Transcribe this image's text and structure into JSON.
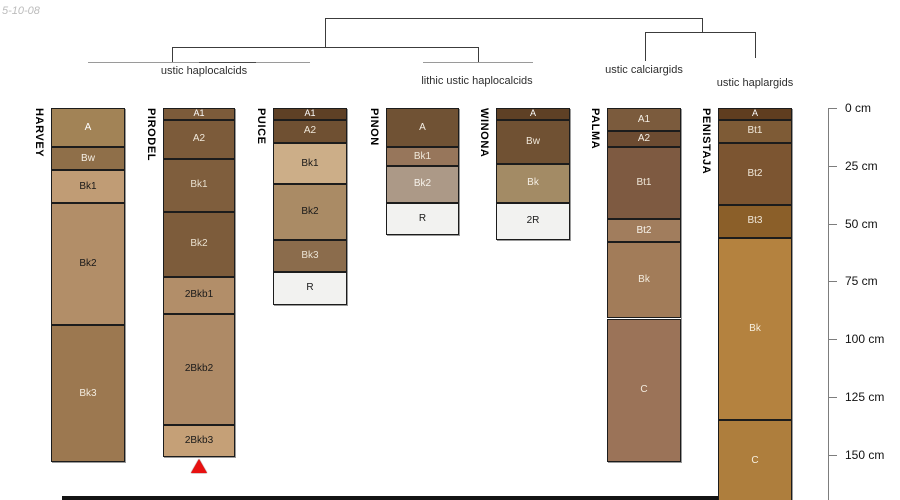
{
  "date_label": "5-10-08",
  "dendrogram": {
    "groups": [
      {
        "label": "ustic haplocalcids",
        "members": [
          "HARVEY",
          "PIRODEL",
          "PUICE"
        ]
      },
      {
        "label": "lithic ustic haplocalcids",
        "members": [
          "PINON",
          "WINONA"
        ]
      },
      {
        "label": "ustic calciargids",
        "members": [
          "PALMA"
        ]
      },
      {
        "label": "ustic haplargids",
        "members": [
          "PENISTAJA"
        ]
      }
    ]
  },
  "depth_scale": {
    "unit": "cm",
    "ticks": [
      {
        "value": 0,
        "label": "0 cm"
      },
      {
        "value": 25,
        "label": "25 cm"
      },
      {
        "value": 50,
        "label": "50 cm"
      },
      {
        "value": 75,
        "label": "75 cm"
      },
      {
        "value": 100,
        "label": "100 cm"
      },
      {
        "value": 125,
        "label": "125 cm"
      },
      {
        "value": 150,
        "label": "150 cm"
      }
    ]
  },
  "profiles": [
    {
      "name": "HARVEY",
      "x": 51,
      "width": 74,
      "horizons": [
        {
          "label": "A",
          "top_cm": 0,
          "bottom_cm": 17,
          "color": "#a28356",
          "text_color": "#ffffff"
        },
        {
          "label": "Bw",
          "top_cm": 17,
          "bottom_cm": 27,
          "color": "#8f6f49",
          "text_color": "#f5efe5"
        },
        {
          "label": "Bk1",
          "top_cm": 27,
          "bottom_cm": 41,
          "color": "#c09c75",
          "text_color": "#1a1a1a"
        },
        {
          "label": "Bk2",
          "top_cm": 41,
          "bottom_cm": 94,
          "color": "#b28e68",
          "text_color": "#1a1a1a"
        },
        {
          "label": "Bk3",
          "top_cm": 94,
          "bottom_cm": 153,
          "color": "#9c7850",
          "text_color": "#f3ecdf"
        }
      ]
    },
    {
      "name": "PIRODEL",
      "x": 163,
      "width": 72,
      "marker": "red-triangle",
      "horizons": [
        {
          "label": "A1",
          "top_cm": 0,
          "bottom_cm": 5,
          "color": "#7c5b3a",
          "text_color": "#ffffff"
        },
        {
          "label": "A2",
          "top_cm": 5,
          "bottom_cm": 22,
          "color": "#7c5b3a",
          "text_color": "#f0e8da"
        },
        {
          "label": "Bk1",
          "top_cm": 22,
          "bottom_cm": 45,
          "color": "#7f5e3d",
          "text_color": "#e9e0cf"
        },
        {
          "label": "Bk2",
          "top_cm": 45,
          "bottom_cm": 73,
          "color": "#7d5c3b",
          "text_color": "#e9e0cf"
        },
        {
          "label": "2Bkb1",
          "top_cm": 73,
          "bottom_cm": 89,
          "color": "#b28e69",
          "text_color": "#1a1a1a"
        },
        {
          "label": "2Bkb2",
          "top_cm": 89,
          "bottom_cm": 137,
          "color": "#ae8a66",
          "text_color": "#1a1a1a"
        },
        {
          "label": "2Bkb3",
          "top_cm": 137,
          "bottom_cm": 151,
          "color": "#c5a077",
          "text_color": "#1a1a1a"
        }
      ]
    },
    {
      "name": "PUICE",
      "x": 273,
      "width": 74,
      "horizons": [
        {
          "label": "A1",
          "top_cm": 0,
          "bottom_cm": 5,
          "color": "#5e4025",
          "text_color": "#ffffff"
        },
        {
          "label": "A2",
          "top_cm": 5,
          "bottom_cm": 15,
          "color": "#6f5032",
          "text_color": "#f0e8da"
        },
        {
          "label": "Bk1",
          "top_cm": 15,
          "bottom_cm": 33,
          "color": "#ccae88",
          "text_color": "#1a1a1a"
        },
        {
          "label": "Bk2",
          "top_cm": 33,
          "bottom_cm": 57,
          "color": "#aa8b65",
          "text_color": "#1a1a1a"
        },
        {
          "label": "Bk3",
          "top_cm": 57,
          "bottom_cm": 71,
          "color": "#8b6c4c",
          "text_color": "#ebe3d4"
        },
        {
          "label": "R",
          "top_cm": 71,
          "bottom_cm": 85,
          "color": "#f2f2f0",
          "text_color": "#1a1a1a"
        }
      ]
    },
    {
      "name": "PINON",
      "x": 386,
      "width": 73,
      "horizons": [
        {
          "label": "A",
          "top_cm": 0,
          "bottom_cm": 17,
          "color": "#705234",
          "text_color": "#f5efe5"
        },
        {
          "label": "Bk1",
          "top_cm": 17,
          "bottom_cm": 25,
          "color": "#97765b",
          "text_color": "#f0e8da"
        },
        {
          "label": "Bk2",
          "top_cm": 25,
          "bottom_cm": 41,
          "color": "#ac9987",
          "text_color": "#f7f3ec"
        },
        {
          "label": "R",
          "top_cm": 41,
          "bottom_cm": 55,
          "color": "#f2f2f0",
          "text_color": "#1a1a1a"
        }
      ]
    },
    {
      "name": "WINONA",
      "x": 496,
      "width": 74,
      "horizons": [
        {
          "label": "A",
          "top_cm": 0,
          "bottom_cm": 5,
          "color": "#5e4025",
          "text_color": "#ffffff"
        },
        {
          "label": "Bw",
          "top_cm": 5,
          "bottom_cm": 24,
          "color": "#705133",
          "text_color": "#f0e8da"
        },
        {
          "label": "Bk",
          "top_cm": 24,
          "bottom_cm": 41,
          "color": "#a38b65",
          "text_color": "#f5efe5"
        },
        {
          "label": "2R",
          "top_cm": 41,
          "bottom_cm": 57,
          "color": "#f2f2f0",
          "text_color": "#1a1a1a"
        }
      ]
    },
    {
      "name": "PALMA",
      "x": 607,
      "width": 74,
      "horizons": [
        {
          "label": "A1",
          "top_cm": 0,
          "bottom_cm": 10,
          "color": "#7b5b3d",
          "text_color": "#f5efe5"
        },
        {
          "label": "A2",
          "top_cm": 10,
          "bottom_cm": 17,
          "color": "#6c4b31",
          "text_color": "#f5efe5"
        },
        {
          "label": "Bt1",
          "top_cm": 17,
          "bottom_cm": 48,
          "color": "#7e5a41",
          "text_color": "#f0e8da"
        },
        {
          "label": "Bt2",
          "top_cm": 48,
          "bottom_cm": 58,
          "color": "#a17d5d",
          "text_color": "#f7f3ec"
        },
        {
          "label": "Bk",
          "top_cm": 58,
          "bottom_cm": 91,
          "color": "#a27c59",
          "text_color": "#f3ecdf"
        },
        {
          "label": "C",
          "top_cm": 91,
          "bottom_cm": 153,
          "color": "#9b7358",
          "text_color": "#f3ecdf"
        }
      ]
    },
    {
      "name": "PENISTAJA",
      "x": 718,
      "width": 74,
      "horizons": [
        {
          "label": "A",
          "top_cm": 0,
          "bottom_cm": 5,
          "color": "#5f3d1f",
          "text_color": "#ffffff"
        },
        {
          "label": "Bt1",
          "top_cm": 5,
          "bottom_cm": 15,
          "color": "#7e5b36",
          "text_color": "#f0e8da"
        },
        {
          "label": "Bt2",
          "top_cm": 15,
          "bottom_cm": 42,
          "color": "#7c5531",
          "text_color": "#f0e8da"
        },
        {
          "label": "Bt3",
          "top_cm": 42,
          "bottom_cm": 56,
          "color": "#8b5f29",
          "text_color": "#f0e8da"
        },
        {
          "label": "Bk",
          "top_cm": 56,
          "bottom_cm": 135,
          "color": "#b4823f",
          "text_color": "#f7f0e0"
        },
        {
          "label": "C",
          "top_cm": 135,
          "bottom_cm": 170,
          "color": "#ae7e3d",
          "text_color": "#f7f0e0"
        }
      ]
    }
  ]
}
